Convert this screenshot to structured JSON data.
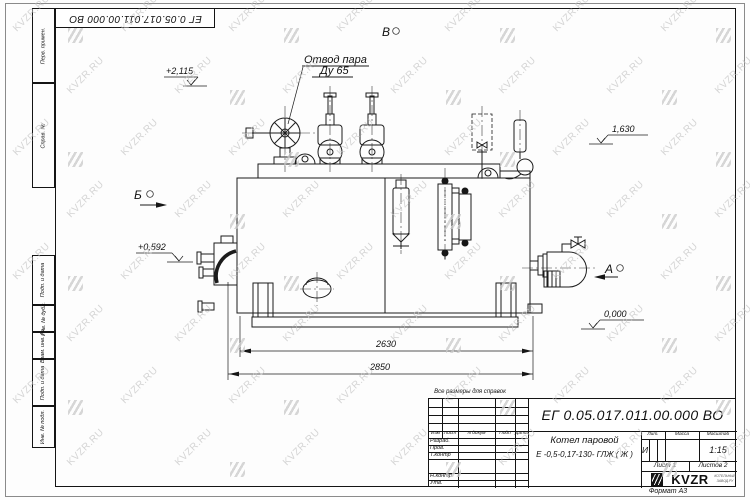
{
  "page": {
    "doc_number_top": "ЕГ 0.05.017.011.00.000  ВО",
    "reference_note": "Все размеры для справок",
    "format_label": "Формат А3"
  },
  "watermark": {
    "text": "KVZR.RU",
    "color": "#c3c3c3"
  },
  "margin_boxes": [
    {
      "label": "Перв. примен."
    },
    {
      "label": "Справ. №"
    },
    {
      "label": "Подп. и дата"
    },
    {
      "label": "Инв. № дубл."
    },
    {
      "label": "Взам. инв. №"
    },
    {
      "label": "Подп. и дата"
    },
    {
      "label": "Инв. № подл."
    }
  ],
  "annotations": {
    "steam_outlet_line1": "Отвод пара",
    "steam_outlet_line2": "Ду 65",
    "view_v": "В",
    "view_b": "Б",
    "view_a": "А",
    "level_top": "+2,115",
    "level_right": "1,630",
    "level_left": "+0,592",
    "level_zero": "0,000",
    "dim_inner": "2630",
    "dim_outer": "2850"
  },
  "title_block": {
    "doc_number": "ЕГ 0.05.017.011.00.000  ВО",
    "product_line1": "Котел паровой",
    "product_line2": "Е -0,5-0,17-130- ГЛЖ ( Ж )",
    "header_cols": [
      "Изм",
      "Лист",
      "N докум",
      "Подп",
      "Дата"
    ],
    "sig_rows": [
      "Разраб.",
      "Пров.",
      "Т.контр",
      "Н.контр",
      "Утв."
    ],
    "lit_label": "Лит.",
    "mass_label": "Масса",
    "scale_label": "Масштаб",
    "lit_value": "И",
    "scale_value": "1:15",
    "sheet_label": "Лист 1",
    "sheets_label": "Листов 2",
    "logo_text": "KVZR",
    "logo_caption_line1": "КОТЕЛЬНЫЙ",
    "logo_caption_line2": "ЗАВОД.РУ"
  }
}
